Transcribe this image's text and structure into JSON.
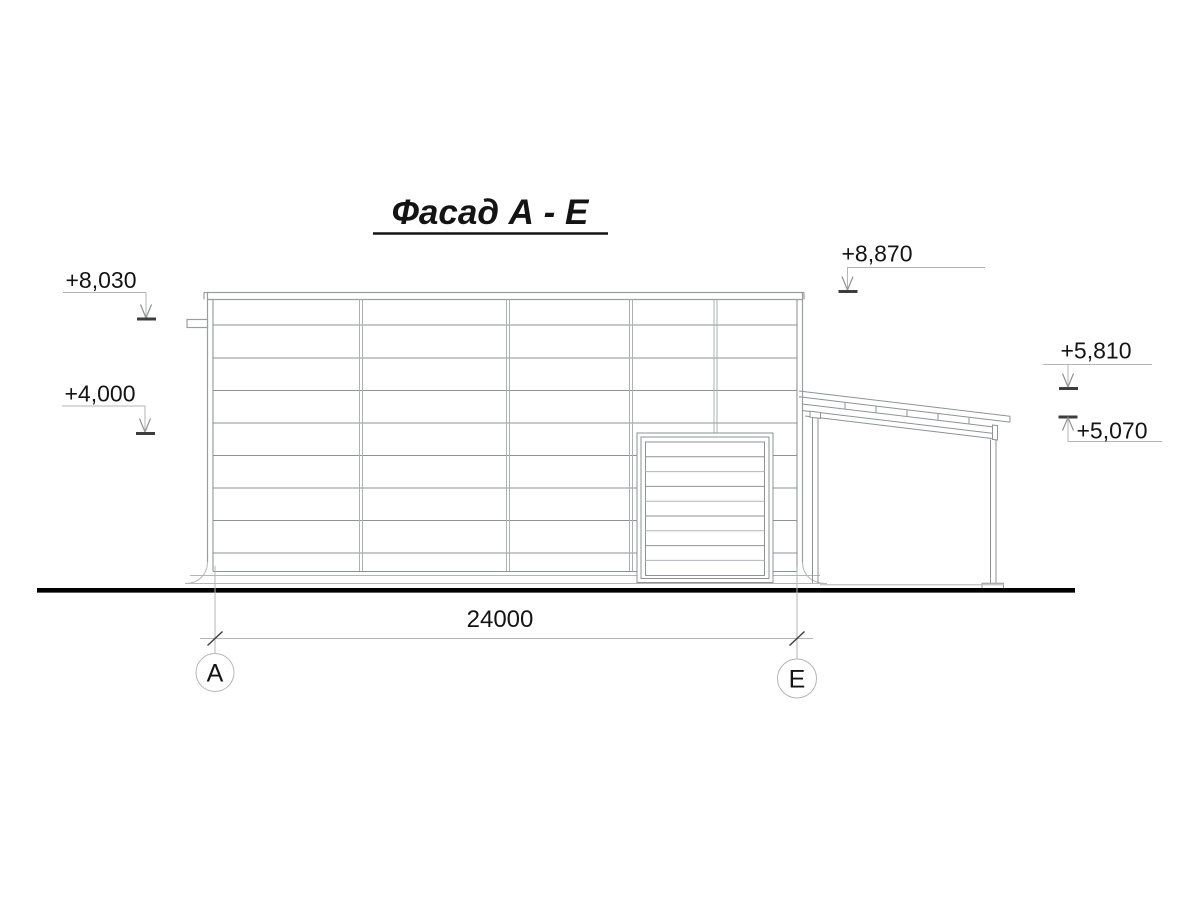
{
  "drawing": {
    "title": "Фасад А - Е",
    "dimension": {
      "value": "24000"
    },
    "axes": {
      "left": "А",
      "right": "Е"
    },
    "elevations": {
      "parapet_left": "+8,030",
      "wall_mid": "+4,000",
      "roof_top": "+8,870",
      "canopy_high": "+5,810",
      "canopy_low": "+5,070"
    },
    "colors": {
      "ink": "#141414",
      "line_gray": "#9b9ea1",
      "ground": "#000000"
    }
  }
}
